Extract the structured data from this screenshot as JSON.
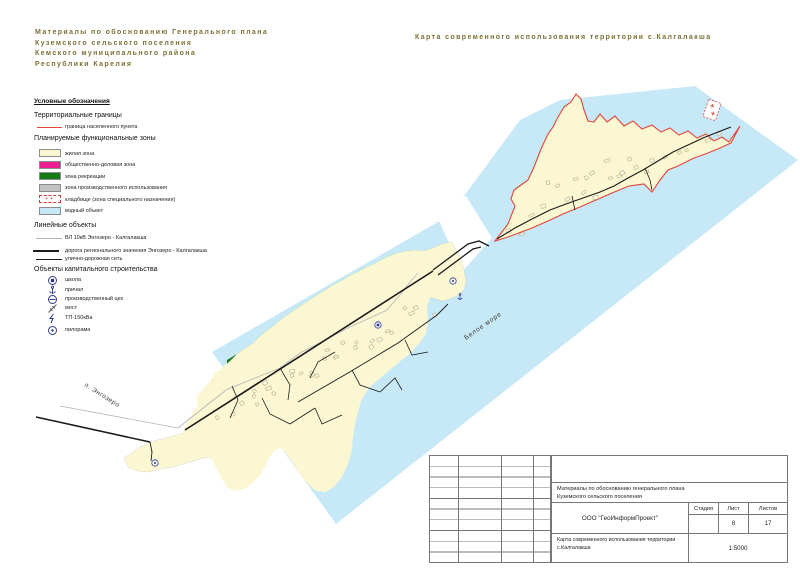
{
  "header": {
    "left_lines": [
      "Материалы по обоснованию Генерального плана",
      "Куземского сельского поселения",
      "Кемского муниципального района",
      "Республики Карелия"
    ],
    "right_title": "Карта современного использования территории с.Калгалакша"
  },
  "legend": {
    "title": "Условные обозначения",
    "sections": [
      {
        "title": "Территориальные границы",
        "items": [
          {
            "label": "граница населенного пункта",
            "swatch": "red-line"
          }
        ]
      },
      {
        "title": "Планируемые функциональные зоны",
        "items": [
          {
            "label": "жилая зона",
            "swatch": "residential",
            "color": "#FBF7D2"
          },
          {
            "label": "общественно-деловая зона",
            "swatch": "business",
            "color": "#EC1E90"
          },
          {
            "label": "зона рекреации",
            "swatch": "recreation",
            "color": "#157A15"
          },
          {
            "label": "зона производственного использования",
            "swatch": "industrial",
            "color": "#C2C2C2"
          },
          {
            "label": "кладбище (зона специального назначения)",
            "swatch": "cemetery"
          },
          {
            "label": "водный объект",
            "swatch": "water",
            "color": "#C6E8F7"
          }
        ]
      },
      {
        "title": "Линейные объекты",
        "items": [
          {
            "label": "ВЛ 10кВ Энгозеро - Калгалакша",
            "swatch": "thin-line"
          },
          {
            "label": "дорога регионального значения Энгозеро - Калгалакша",
            "swatch": "thick-line"
          },
          {
            "label": "улично-дорожная сеть",
            "swatch": "medium-line"
          }
        ]
      },
      {
        "title": "Объекты капитального строительства",
        "items": [
          {
            "label": "школа",
            "icon": "school-icon"
          },
          {
            "label": "причал",
            "icon": "anchor-icon"
          },
          {
            "label": "производственный цех",
            "icon": "workshop-icon"
          },
          {
            "label": "мост",
            "icon": "bridge-icon"
          },
          {
            "label": "ТП-150кВа",
            "icon": "transformer-icon"
          },
          {
            "label": "пилорама",
            "icon": "sawmill-icon"
          }
        ]
      }
    ]
  },
  "map": {
    "labels": {
      "sea": "Белое море",
      "settlement": "п. Энгозеро"
    }
  },
  "title_block": {
    "project_line1": "Материалы по обоснованию генерального плана",
    "project_line2": "Куземского сельского поселения",
    "company": "ООО \"ГеоИнформПроект\"",
    "stage_label": "Стадия",
    "sheet_label": "Лист",
    "sheets_label": "Листов",
    "stage_value": "",
    "sheet_value": "8",
    "sheets_value": "17",
    "map_title_line1": "Карта современного использования территории",
    "map_title_line2": "с.Калгалакша",
    "scale": "1:5000"
  },
  "colors": {
    "header_text": "#7c7036",
    "boundary_red": "#E2453A",
    "residential": "#FBF7D2",
    "business": "#EC1E90",
    "recreation": "#157A15",
    "industrial": "#C2C2C2",
    "water": "#C6E8F7",
    "road": "#1a1a1a",
    "power_line": "#b5b5b5",
    "icon_navy": "#2a3490"
  }
}
